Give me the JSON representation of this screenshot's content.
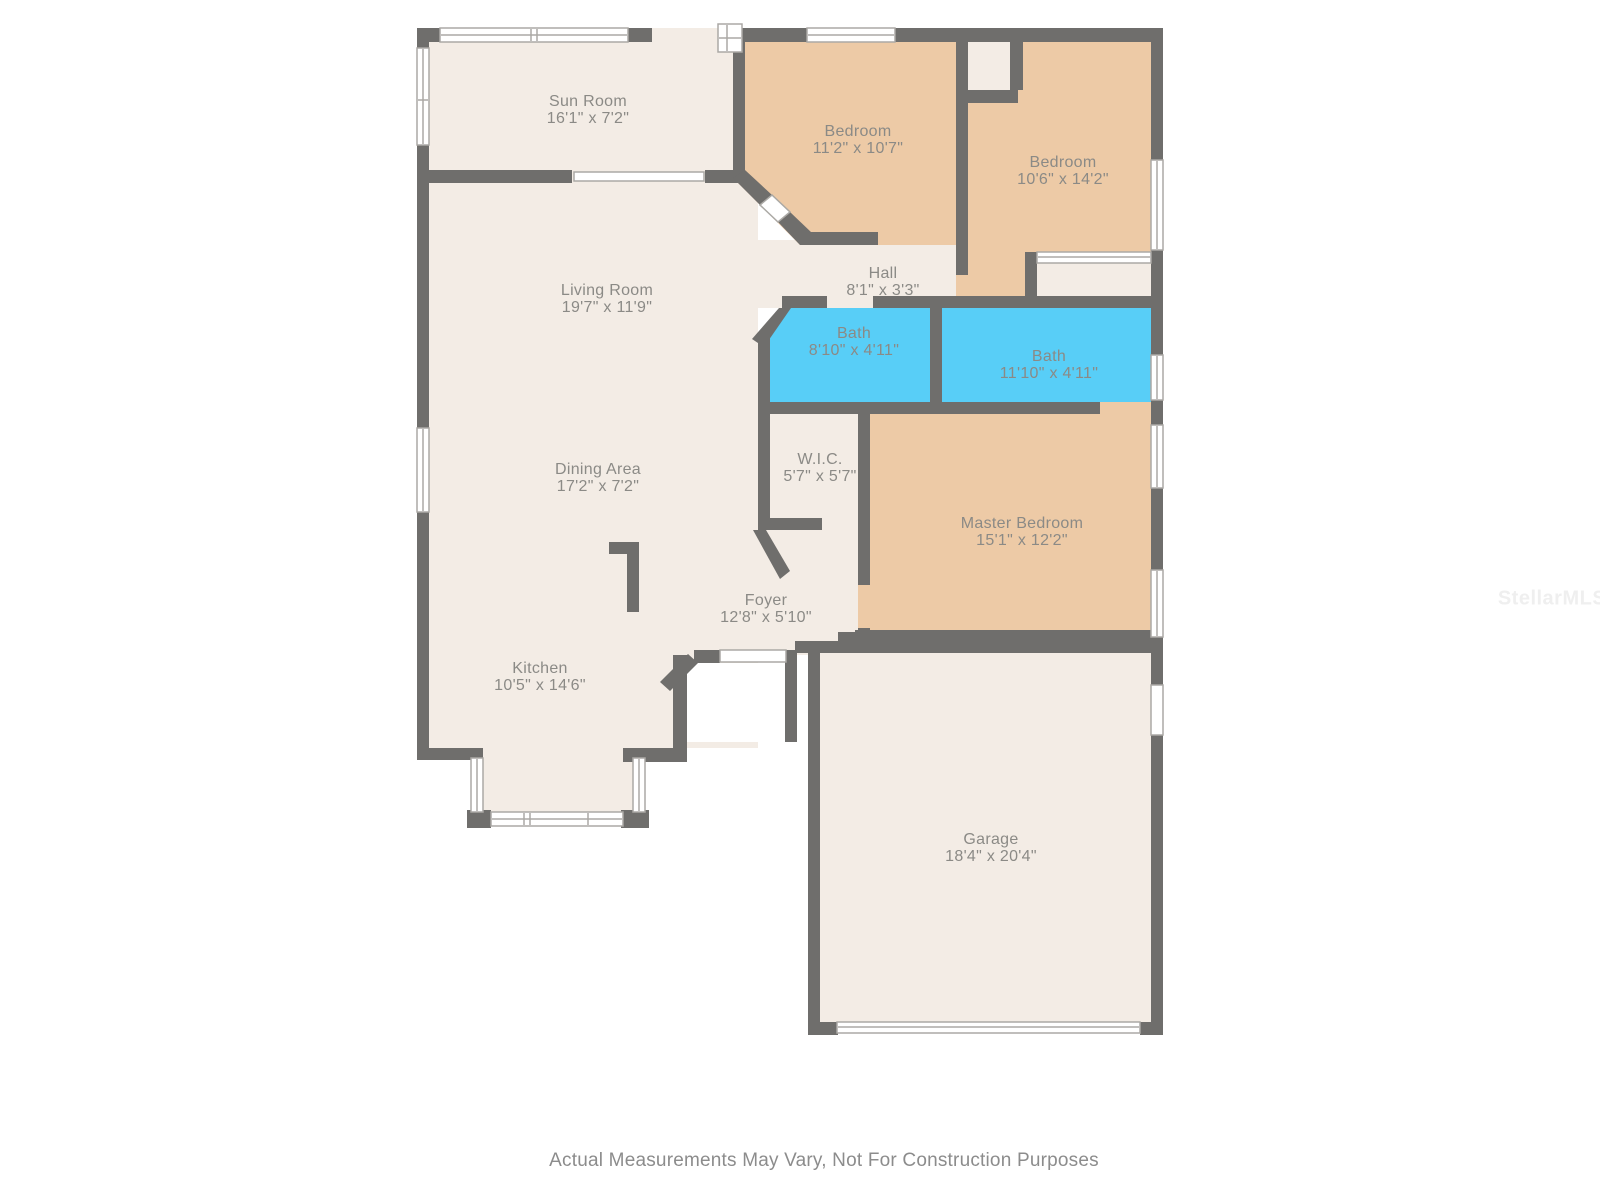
{
  "floor_plan": {
    "rooms": [
      {
        "id": "sun-room",
        "name": "Sun Room",
        "dims": "16'1\" x 7'2\""
      },
      {
        "id": "bedroom-1",
        "name": "Bedroom",
        "dims": "11'2\" x 10'7\""
      },
      {
        "id": "bedroom-2",
        "name": "Bedroom",
        "dims": "10'6\" x 14'2\""
      },
      {
        "id": "hall",
        "name": "Hall",
        "dims": "8'1\" x 3'3\""
      },
      {
        "id": "bath-1",
        "name": "Bath",
        "dims": "8'10\" x 4'11\""
      },
      {
        "id": "bath-2",
        "name": "Bath",
        "dims": "11'10\" x 4'11\""
      },
      {
        "id": "living-room",
        "name": "Living Room",
        "dims": "19'7\" x 11'9\""
      },
      {
        "id": "dining-area",
        "name": "Dining Area",
        "dims": "17'2\" x 7'2\""
      },
      {
        "id": "wic",
        "name": "W.I.C.",
        "dims": "5'7\" x 5'7\""
      },
      {
        "id": "master-bedroom",
        "name": "Master Bedroom",
        "dims": "15'1\" x 12'2\""
      },
      {
        "id": "foyer",
        "name": "Foyer",
        "dims": "12'8\" x 5'10\""
      },
      {
        "id": "kitchen",
        "name": "Kitchen",
        "dims": "10'5\" x 14'6\""
      },
      {
        "id": "garage",
        "name": "Garage",
        "dims": "18'4\" x 20'4\""
      }
    ],
    "footer_disclaimer": "Actual Measurements May Vary, Not For Construction Purposes",
    "watermark": "StellarMLS",
    "colors": {
      "wall": "#6f6e6c",
      "floor": "#f3ece5",
      "bedroom": "#edcaa6",
      "bath": "#58cef7",
      "window_fill": "#ffffff",
      "window_trim": "#aba9a5",
      "porch": "#ffffff",
      "label_text": "#8b8a86",
      "disclaimer_text": "#8c8c8c",
      "watermark_text": "#efefef"
    }
  }
}
